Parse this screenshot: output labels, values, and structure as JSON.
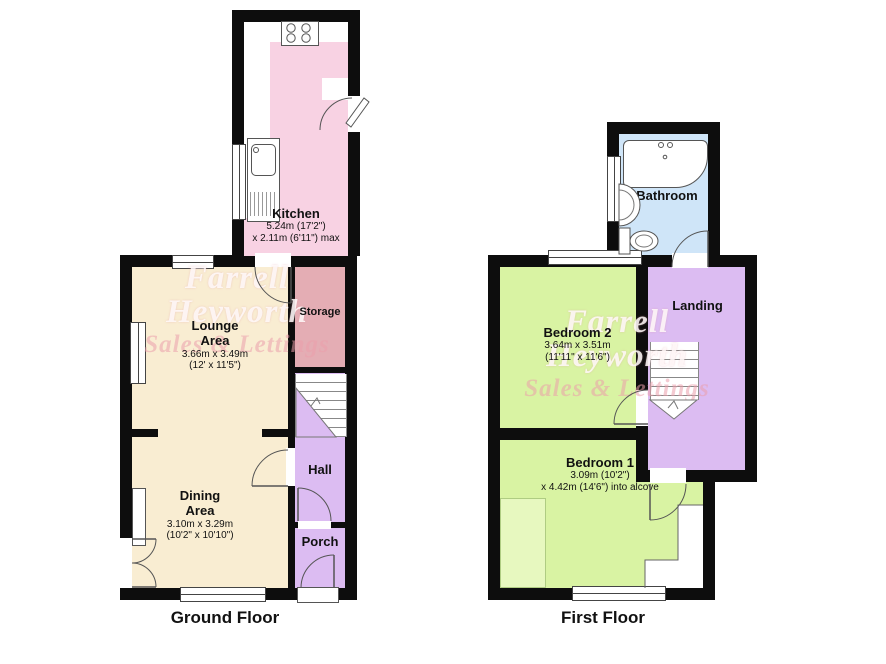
{
  "watermark": {
    "line1": "Farrell",
    "line2": "Heyworth",
    "line3": "Sales & Lettings"
  },
  "ground_floor": {
    "label": "Ground Floor",
    "kitchen": {
      "name": "Kitchen",
      "dim1": "5.24m (17'2\")",
      "dim2": "x 2.11m (6'11\") max"
    },
    "lounge": {
      "name1": "Lounge",
      "name2": "Area",
      "dim1": "3.66m x 3.49m",
      "dim2": "(12' x 11'5\")"
    },
    "dining": {
      "name1": "Dining",
      "name2": "Area",
      "dim1": "3.10m x 3.29m",
      "dim2": "(10'2\" x 10'10\")"
    },
    "storage": {
      "name": "Storage"
    },
    "hall": {
      "name": "Hall"
    },
    "porch": {
      "name": "Porch"
    }
  },
  "first_floor": {
    "label": "First Floor",
    "bathroom": {
      "name": "Bathroom"
    },
    "landing": {
      "name": "Landing"
    },
    "bedroom2": {
      "name": "Bedroom 2",
      "dim1": "3.64m x 3.51m",
      "dim2": "(11'11\" x 11'6\")"
    },
    "bedroom1": {
      "name": "Bedroom 1",
      "dim1": "3.09m (10'2\")",
      "dim2": "x 4.42m (14'6\") into alcove"
    }
  },
  "colors": {
    "wall": "#0d0d0d",
    "kitchen_floor": "#f8d2e3",
    "lounge_dining_floor": "#f9edd2",
    "storage_floor": "#e4adb4",
    "hall_porch_landing_floor": "#dcbcf2",
    "bathroom_floor": "#cfe5f8",
    "bedroom_floor": "#d9f3a3"
  }
}
